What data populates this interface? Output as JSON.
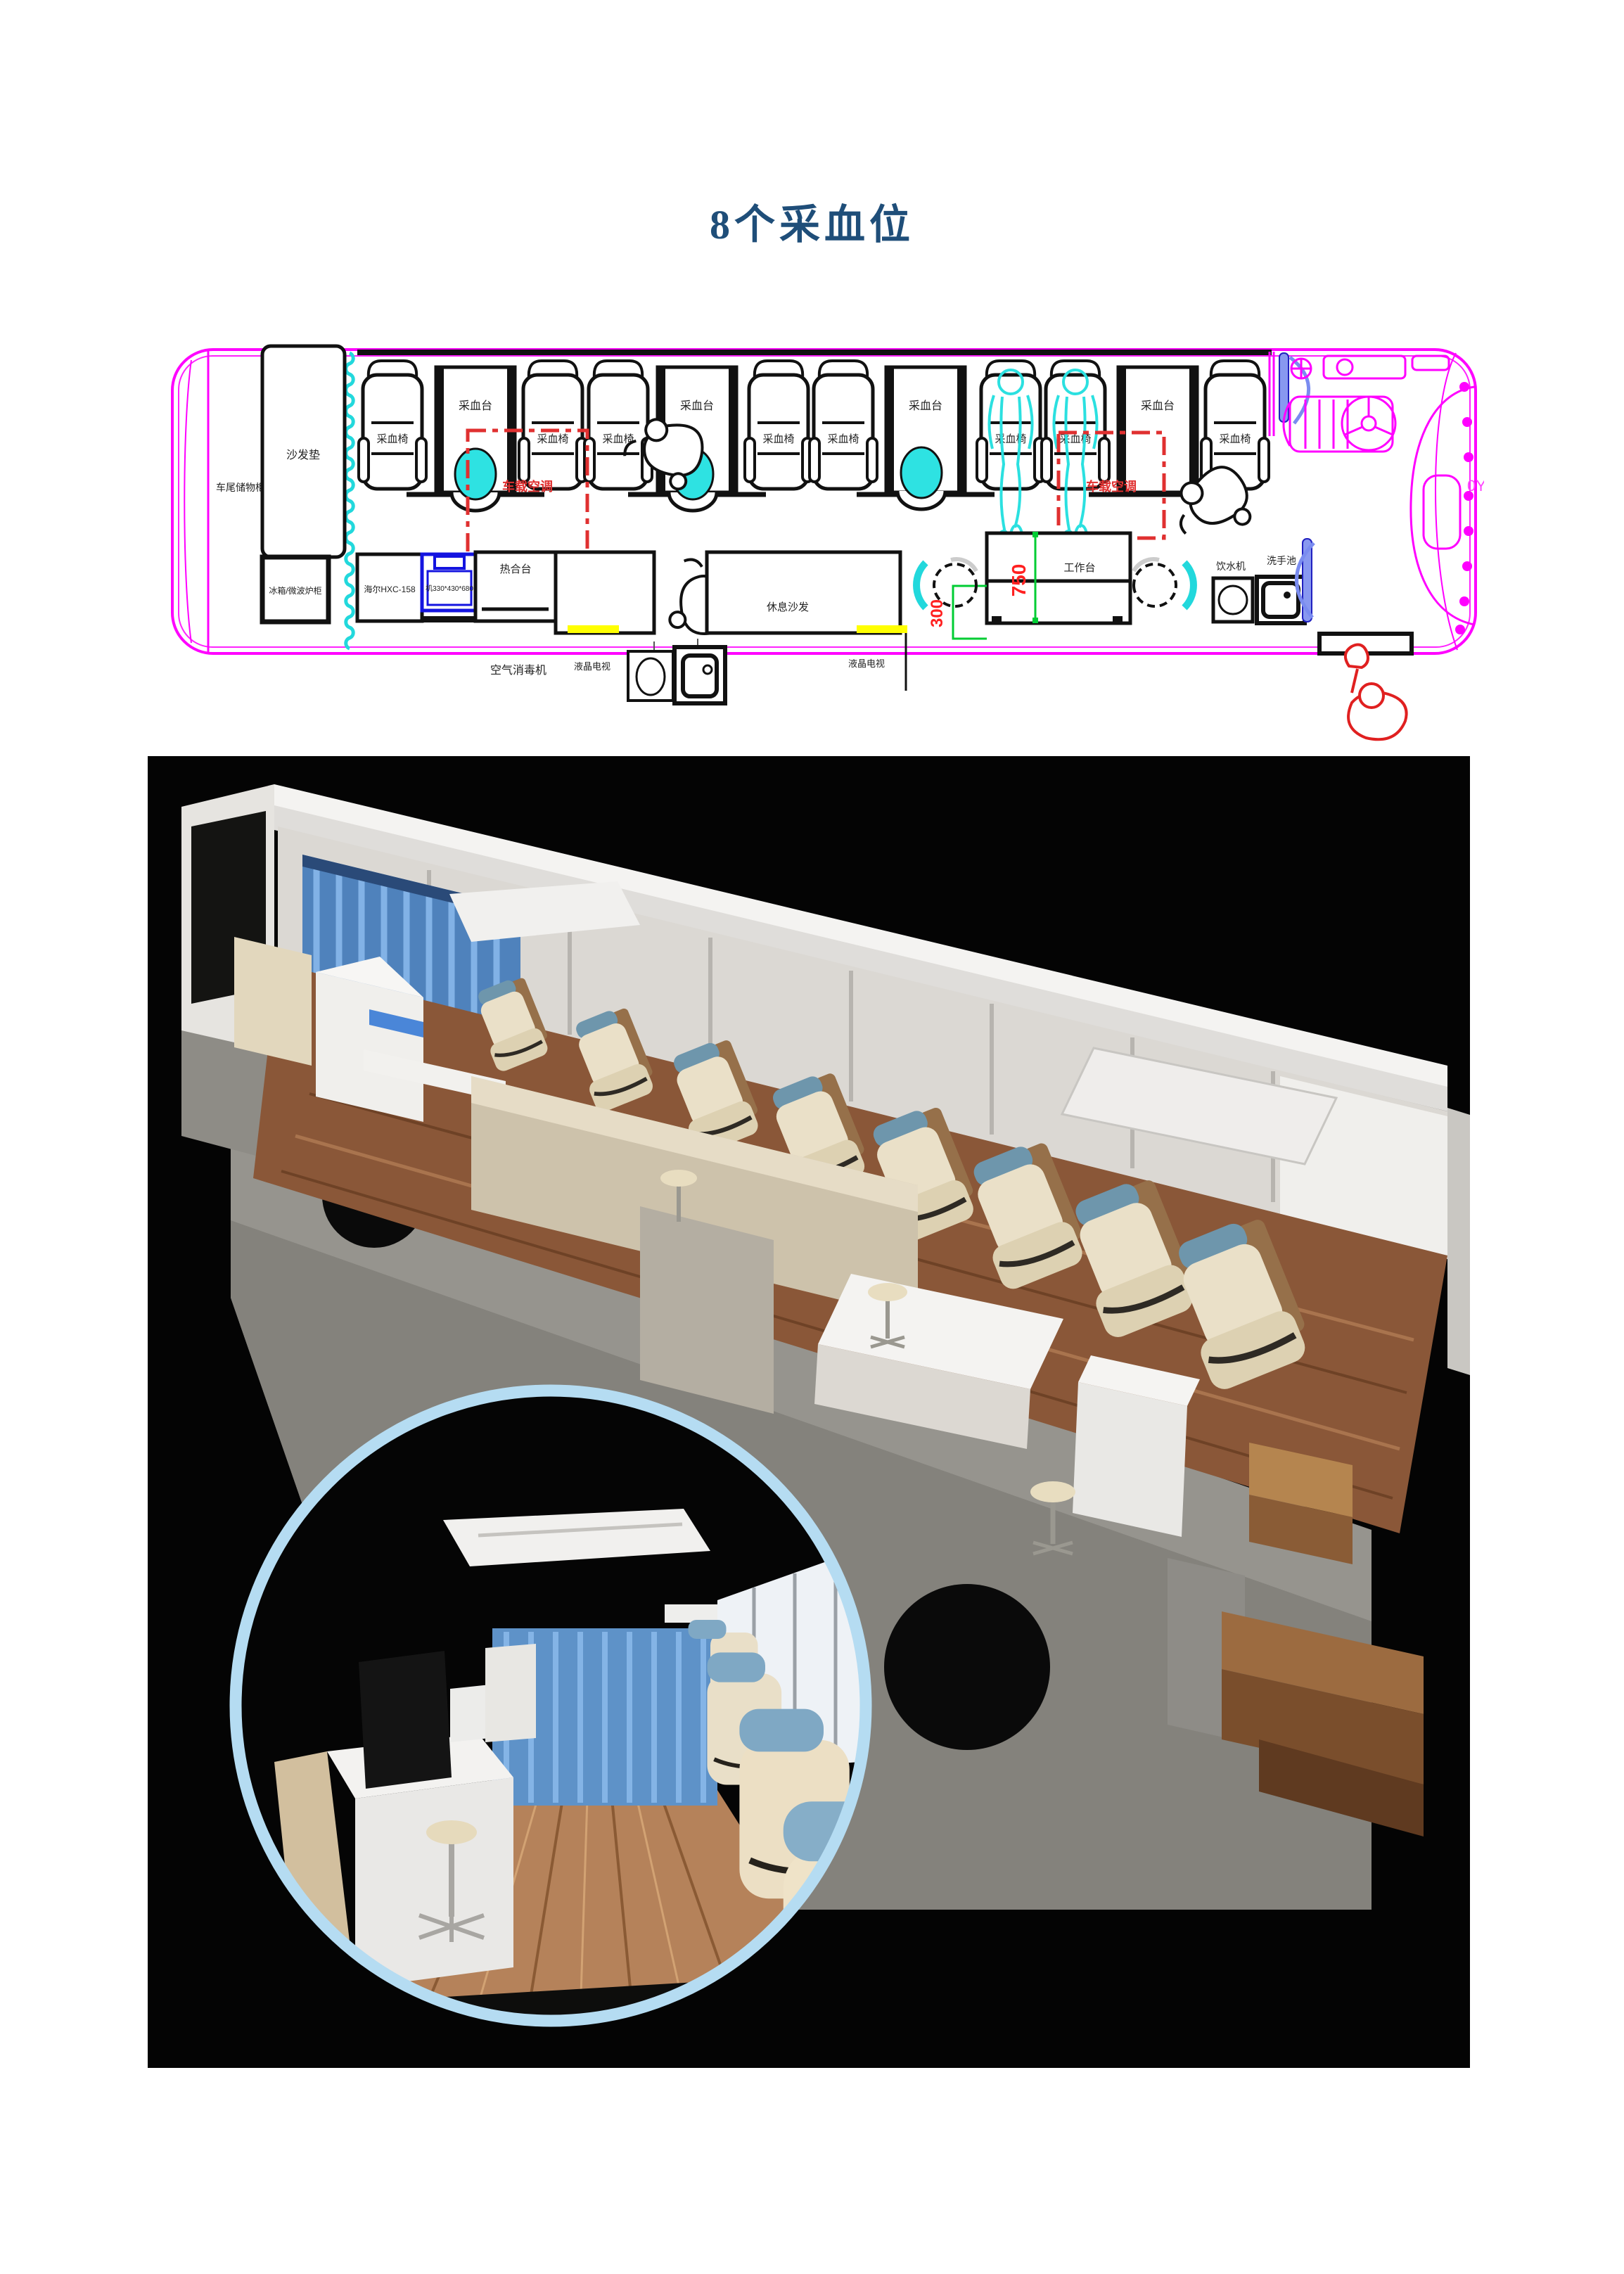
{
  "page": {
    "title": "8个采血位"
  },
  "colors": {
    "title_blue": "#1f4e79",
    "bus_outline_magenta": "#ff00ff",
    "curtain_cyan": "#2ae0e0",
    "ac_red": "#e03030",
    "dimension_green": "#00cc33",
    "dimension_red": "#ff2020",
    "tv_yellow": "#ffff00",
    "equipment_blue": "#1414e0",
    "inset_ring_blue": "#b5dcf2",
    "chair_cream": "#eae0c8",
    "headrest_blue": "#6e96ac",
    "floor_wood": "#8a5738"
  },
  "floor_plan": {
    "labels": {
      "medical_curtain": "医用帘",
      "blood_chair": "采血椅",
      "blood_table": "采血台",
      "vehicle_ac": "车载空调",
      "rear_storage": "车尾储物柜",
      "sofa_cushion": "沙发垫",
      "fridge_microwave": "冰箱/微波炉柜",
      "haier_unit": "海尔HXC-158",
      "blue_unit": "机330*430*680",
      "heat_sealer": "热合台",
      "air_sterilizer": "空气消毒机",
      "lcd_tv": "液晶电视",
      "rest_sofa": "休息沙发",
      "workbench": "工作台",
      "water_dispenser": "饮水机",
      "hand_wash_sink": "洗手池",
      "dim_750": "750",
      "dim_300": "300",
      "edge_mark": "0Y"
    },
    "counts": {
      "blood_chairs": 8,
      "blood_tables": 4,
      "aisle_stools": 3,
      "ac_zones": 2
    }
  }
}
